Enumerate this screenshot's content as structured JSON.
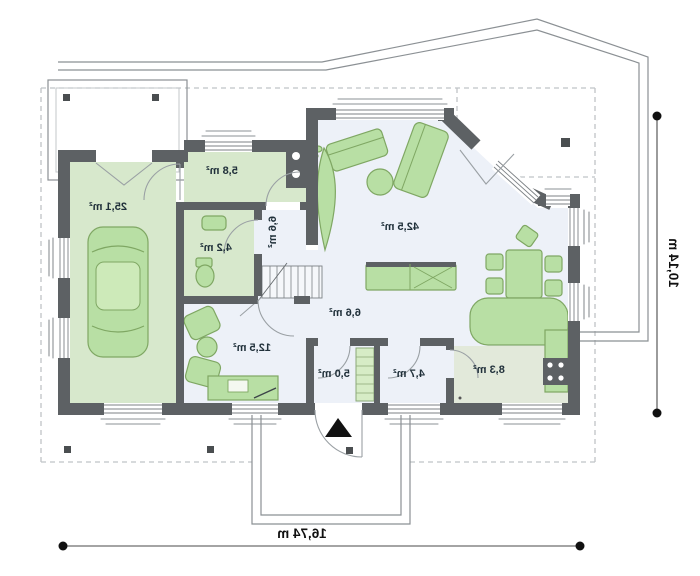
{
  "floor_plan": {
    "rooms": {
      "garage": {
        "area": "25,1 m²"
      },
      "utility_room": {
        "area": "5,8 m²"
      },
      "toilet": {
        "area": "4,2 m²"
      },
      "corridor": {
        "area": "6,6 m²"
      },
      "living_room": {
        "area": "42,5 m²"
      },
      "hall": {
        "area": "6,6 m²"
      },
      "bedroom": {
        "area": "12,5 m²"
      },
      "vestibule": {
        "area": "5,0 m²"
      },
      "bathroom": {
        "area": "4,7 m²"
      },
      "kitchen": {
        "area": "8,3 m²"
      }
    },
    "dimensions": {
      "total_width": "16,74 m",
      "total_depth": "10,14 m"
    },
    "colors": {
      "wall": "#5d6164",
      "room_green": "#d7e8cc",
      "room_light": "#edf1f8",
      "room_kitchen": "#e2e9da",
      "furniture": "#b8dfa4",
      "furniture_stroke": "#7fa763"
    }
  }
}
